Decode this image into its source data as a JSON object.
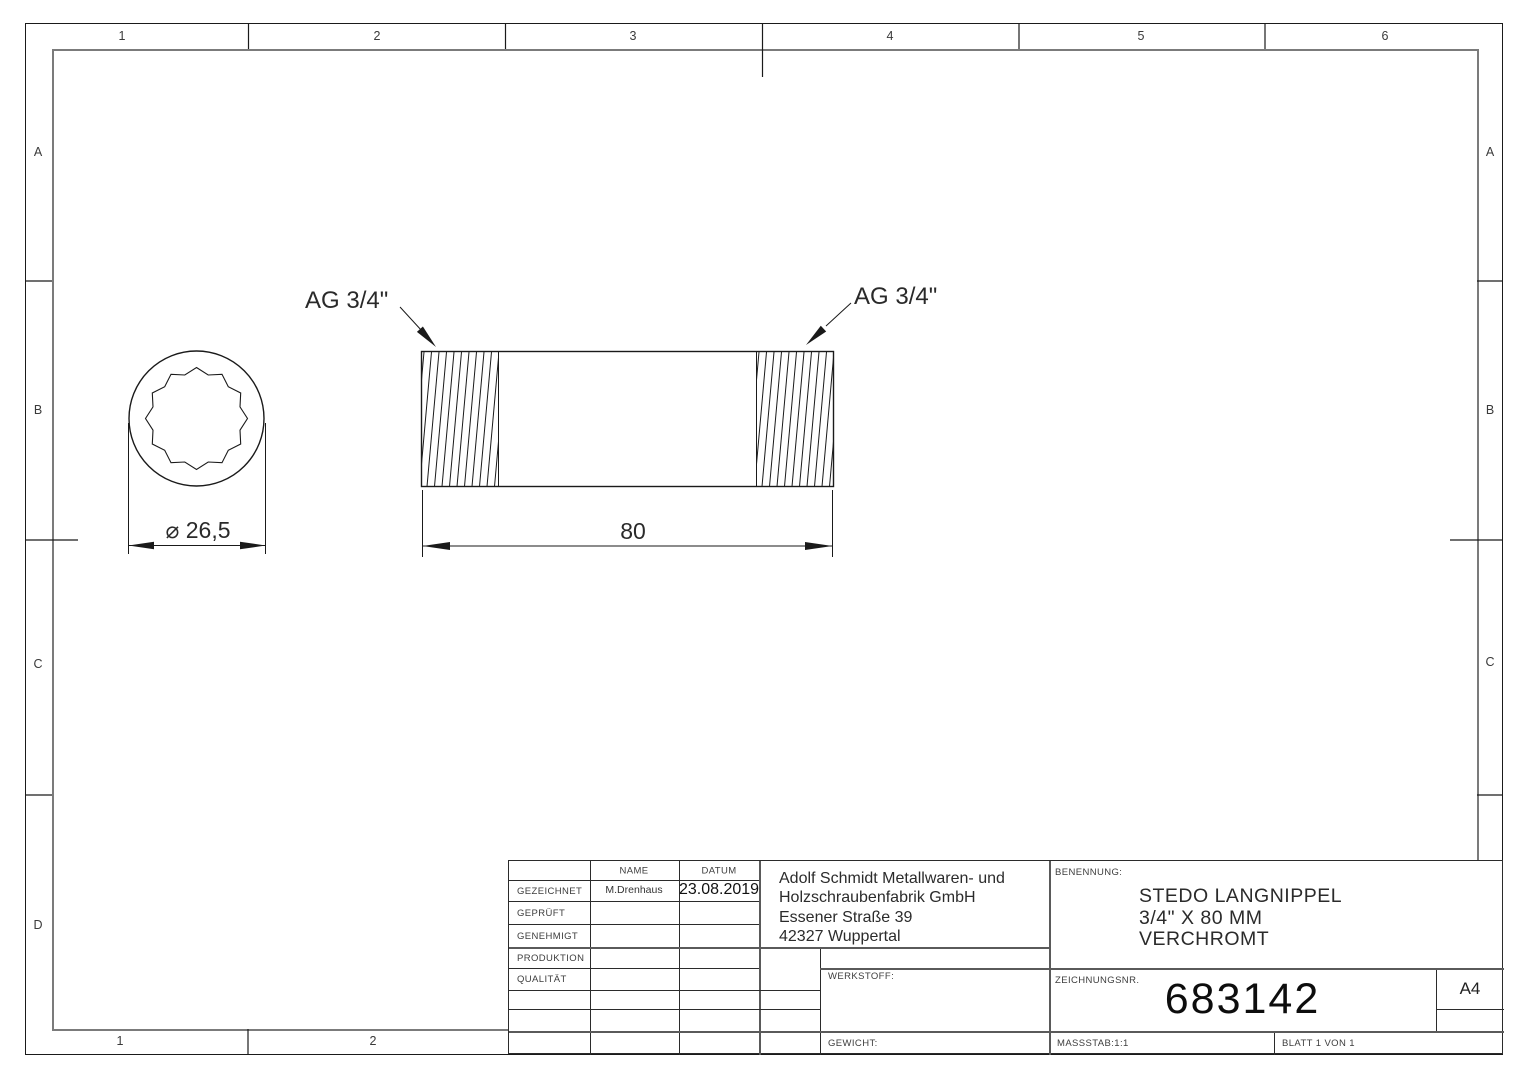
{
  "sheet": {
    "border": {
      "top": [
        "1",
        "2",
        "3",
        "4",
        "5",
        "6"
      ],
      "bottom": [
        "1",
        "2"
      ],
      "left": [
        "A",
        "B",
        "C",
        "D"
      ],
      "right": [
        "A",
        "B",
        "C"
      ]
    },
    "annotations": {
      "thread_left": "AG 3/4\"",
      "thread_right": "AG 3/4\"",
      "diameter": "⌀ 26,5",
      "length": "80"
    },
    "title_block": {
      "approval": {
        "name_header": "NAME",
        "date_header": "DATUM",
        "rows": [
          {
            "label": "GEZEICHNET",
            "name": "M.Drenhaus",
            "date": "23.08.2019"
          },
          {
            "label": "GEPRÜFT",
            "name": "",
            "date": ""
          },
          {
            "label": "GENEHMIGT",
            "name": "",
            "date": ""
          },
          {
            "label": "PRODUKTION",
            "name": "",
            "date": ""
          },
          {
            "label": "QUALITÄT",
            "name": "",
            "date": ""
          }
        ]
      },
      "company": [
        "Adolf Schmidt Metallwaren- und",
        "Holzschraubenfabrik GmbH",
        "Essener Straße 39",
        "42327 Wuppertal"
      ],
      "werkstoff_label": "WERKSTOFF:",
      "gewicht_label": "GEWICHT:",
      "benennung_label": "BENENNUNG:",
      "benennung": [
        "STEDO LANGNIPPEL",
        "3/4\" X 80 MM",
        "VERCHROMT"
      ],
      "zeichnungsnr_label": "ZEICHNUNGSNR.",
      "zeichnungsnr": "683142",
      "format": "A4",
      "massstab": "MASSSTAB:1:1",
      "blatt": "BLATT 1 VON 1"
    },
    "colors": {
      "line": "#1a1a1a",
      "frame_gray": "#7b7b7b"
    }
  }
}
